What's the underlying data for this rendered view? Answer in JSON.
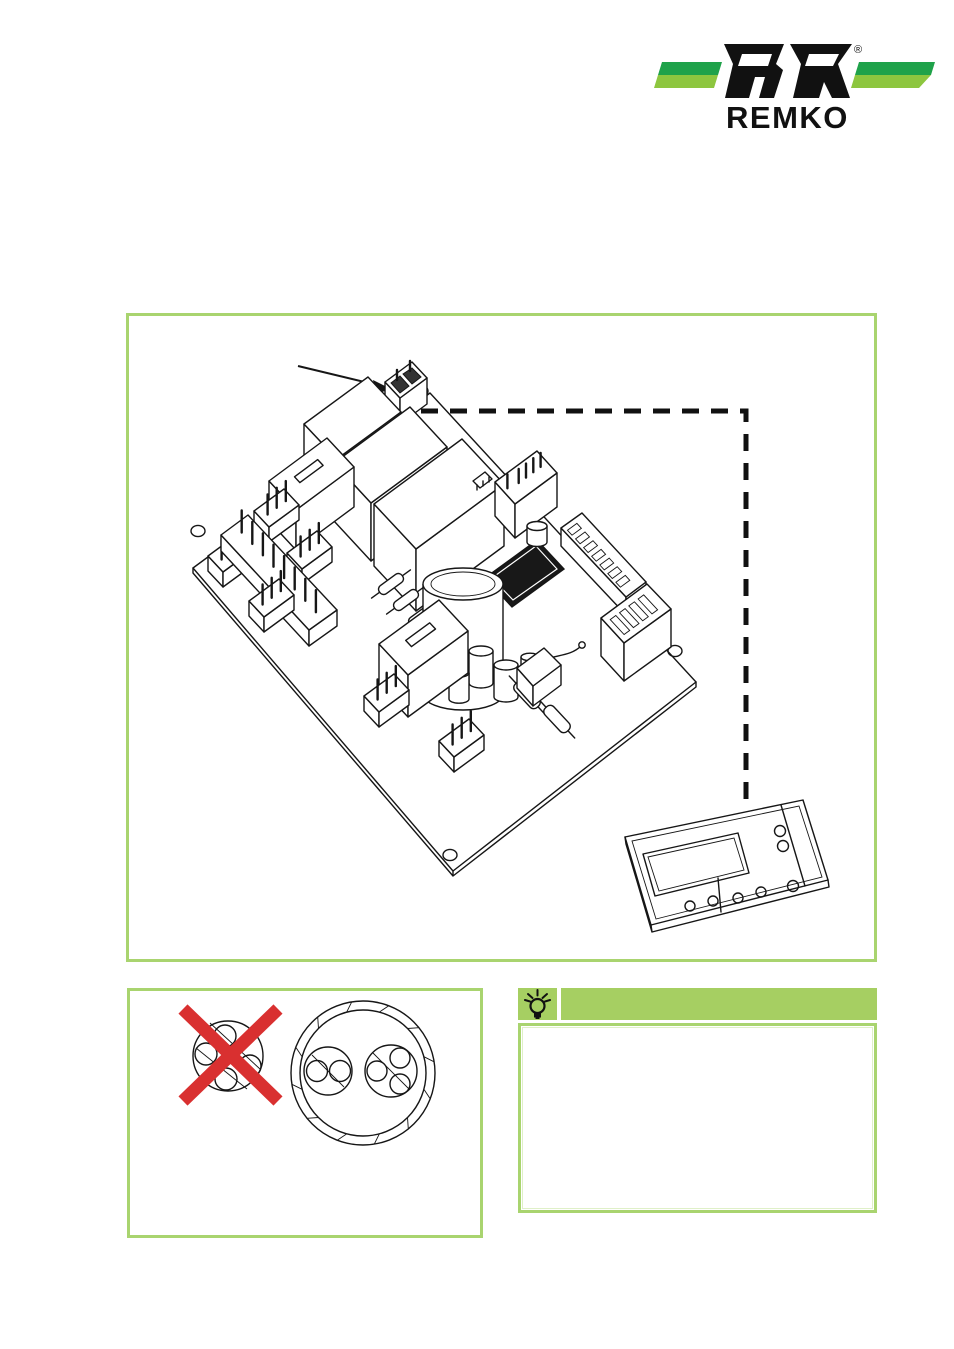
{
  "logo": {
    "brand": "REMKO",
    "registered_mark": "®",
    "colors": {
      "stripe_dark_green": "#1fa24a",
      "stripe_light_green": "#8dc63f",
      "letters": "#111111"
    }
  },
  "colors": {
    "figure_border_green": "#a9d46f",
    "tip_header_green": "#a6cf62",
    "prohibition_red": "#d93030",
    "line_art": "#161616"
  },
  "main_figure": {
    "name": "control-board-isometric-drawing",
    "callout": "arrow-to-plug-connector",
    "connection": "dashed-line-from-connector-to-control-panel",
    "control_panel": "room-control-unit-with-display-and-buttons"
  },
  "cable_figure": {
    "wrong_cable": "single-sheath-four-core-cable-crossed-out",
    "correct_cable": "double-sheathed-cable-with-two-wire-groups"
  },
  "tip_box": {
    "icon": "lightbulb-icon",
    "header_text": ""
  }
}
